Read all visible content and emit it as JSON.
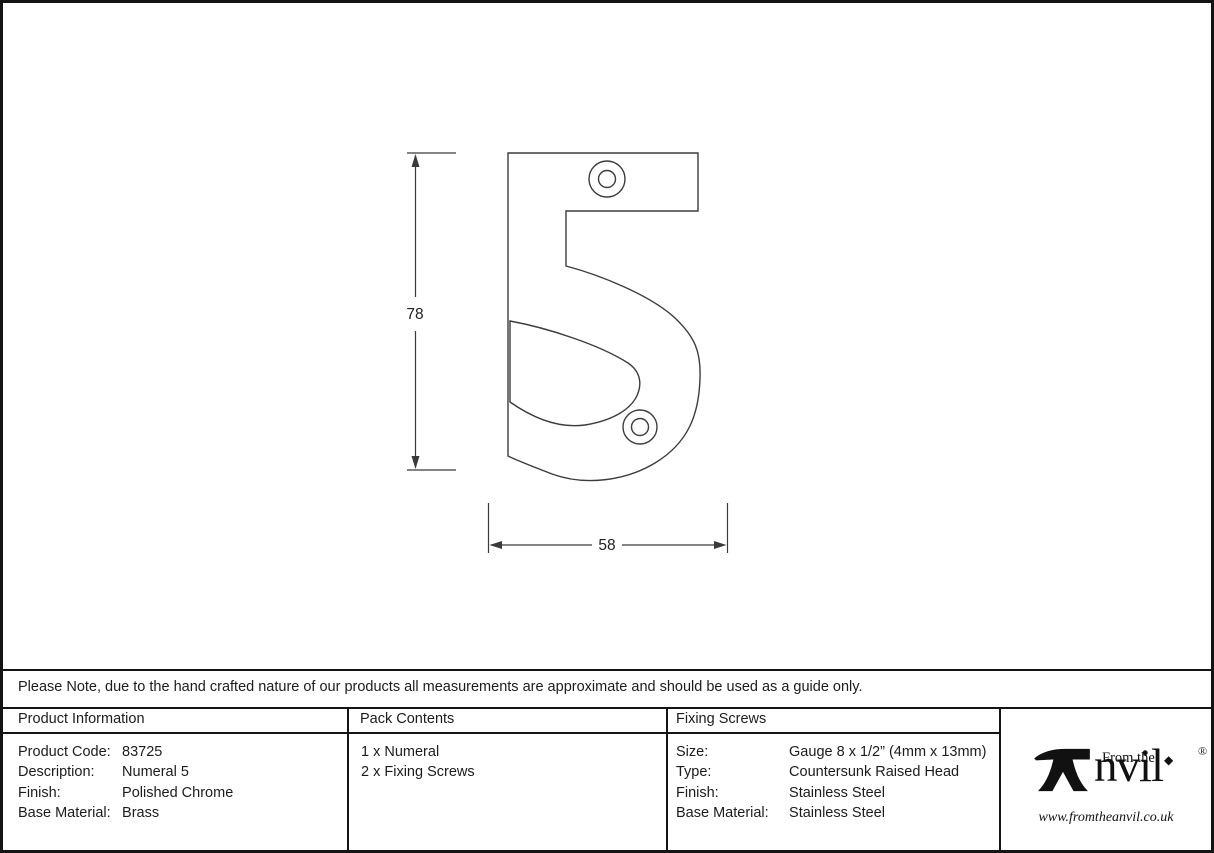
{
  "note": "Please Note, due to the hand crafted nature of our products all measurements are approximate and should be used as a guide only.",
  "drawing": {
    "subject": "Numeral 5 with two fixing screw holes",
    "height_dimension": "78",
    "width_dimension": "58"
  },
  "sections": {
    "product_information": {
      "header": "Product Information",
      "rows": [
        {
          "label": "Product Code:",
          "value": "83725"
        },
        {
          "label": "Description:",
          "value": "Numeral 5"
        },
        {
          "label": "Finish:",
          "value": "Polished Chrome"
        },
        {
          "label": "Base Material:",
          "value": "Brass"
        }
      ]
    },
    "pack_contents": {
      "header": "Pack Contents",
      "items": [
        "1 x Numeral",
        "2 x Fixing Screws"
      ]
    },
    "fixing_screws": {
      "header": "Fixing Screws",
      "rows": [
        {
          "label": "Size:",
          "value": "Gauge 8 x 1/2” (4mm x 13mm)"
        },
        {
          "label": "Type:",
          "value": "Countersunk Raised Head"
        },
        {
          "label": "Finish:",
          "value": "Stainless Steel"
        },
        {
          "label": "Base Material:",
          "value": "Stainless Steel"
        }
      ]
    }
  },
  "logo": {
    "prefix": "From the",
    "brand_suffix": "nvil",
    "i_dot": "◆",
    "registered": "®",
    "website": "www.fromtheanvil.co.uk"
  },
  "colors": {
    "line": "#3c3c3c",
    "border": "#141414",
    "text": "#1c1c1c",
    "background": "#ffffff"
  }
}
